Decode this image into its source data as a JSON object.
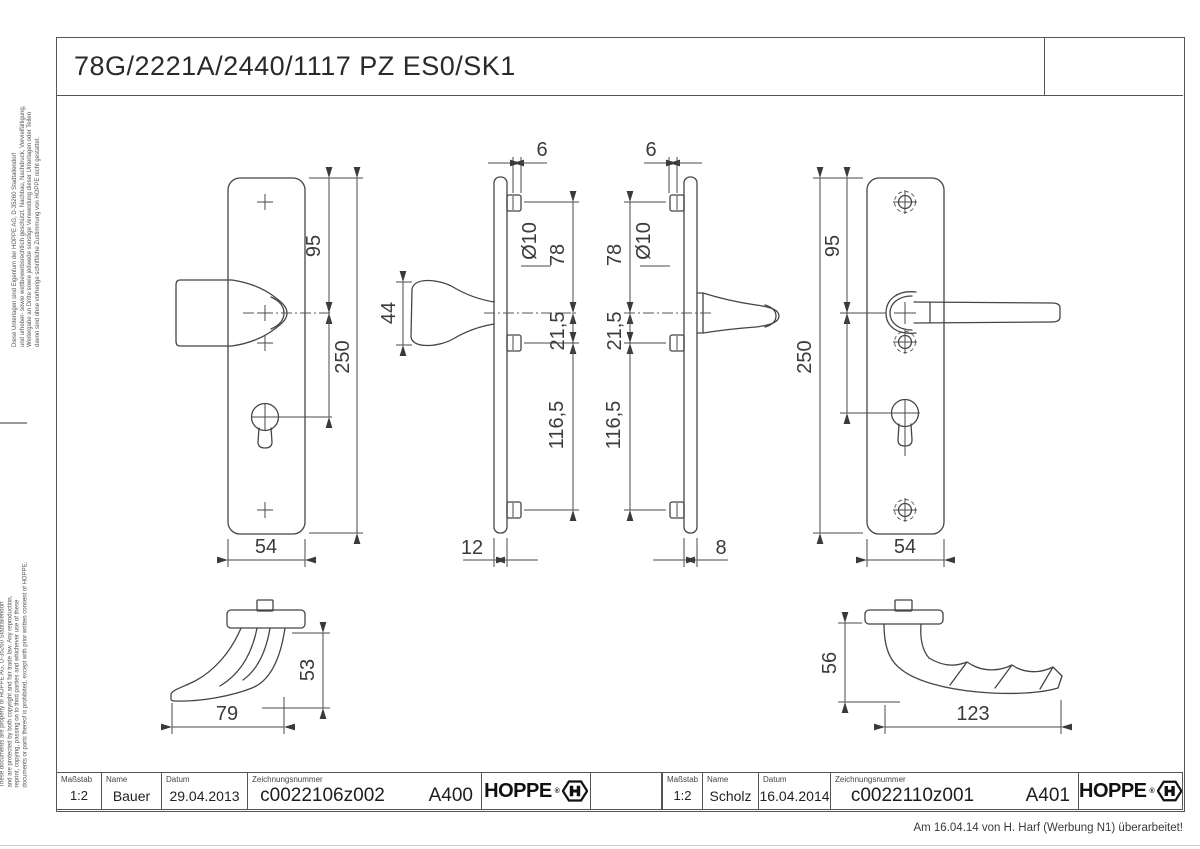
{
  "page": {
    "title": "78G/2221A/2440/1117 PZ ES0/SK1",
    "revision_note": "Am 16.04.14 von H. Harf (Werbung N1) überarbeitet!"
  },
  "side_note_de": [
    "Diese Unterlagen sind Eigentum der HOPPE AG, D-35260 Stadtallendorf",
    "und urheber- sowie wettbewerbsrechtlich geschützt. Nachbau, Nachdruck, Vervielfältigung,",
    "Weitergabe an Dritte sowie jedwede sonstige Verwendung dieser Unterlagen oder Teilen",
    "davon sind ohne vorherige schriftliche Zustimmung von HOPPE nicht gestattet."
  ],
  "side_note_en": [
    "These documents are property of HOPPE AG, D-35260 Stadtallendorf",
    "and are protected by both copyright and fair trade law. Any reproduction,",
    "reprint, copying, passing on to third parties and whichever use of these",
    "documents or parts thereof is prohibited, except with prior written consent of HOPPE."
  ],
  "title_blocks": [
    {
      "scale_label": "Maßstab",
      "scale": "1:2",
      "name_label": "Name",
      "name": "Bauer",
      "date_label": "Datum",
      "date": "29.04.2013",
      "number_label": "Zeichnungsnummer",
      "number": "c0022106z002",
      "sheet": "A400",
      "brand": "HOPPE",
      "registered": "®"
    },
    {
      "scale_label": "Maßstab",
      "scale": "1:2",
      "name_label": "Name",
      "name": "Scholz",
      "date_label": "Datum",
      "date": "16.04.2014",
      "number_label": "Zeichnungsnummer",
      "number": "c0022110z001",
      "sheet": "A401",
      "brand": "HOPPE",
      "registered": "®"
    }
  ],
  "dims": {
    "d1": {
      "v95": "95",
      "v250": "250",
      "v54": "54"
    },
    "d2": {
      "v6": "6",
      "dia": "Ø10",
      "v78": "78",
      "v215": "21,5",
      "v1165": "116,5",
      "v44": "44",
      "v12": "12"
    },
    "d3": {
      "v6": "6",
      "dia": "Ø10",
      "v78": "78",
      "v215": "21,5",
      "v1165": "116,5",
      "v8": "8"
    },
    "d4": {
      "v95": "95",
      "v250": "250",
      "v54": "54"
    },
    "d5": {
      "v53": "53",
      "v79": "79"
    },
    "d6": {
      "v56": "56",
      "v123": "123"
    }
  }
}
